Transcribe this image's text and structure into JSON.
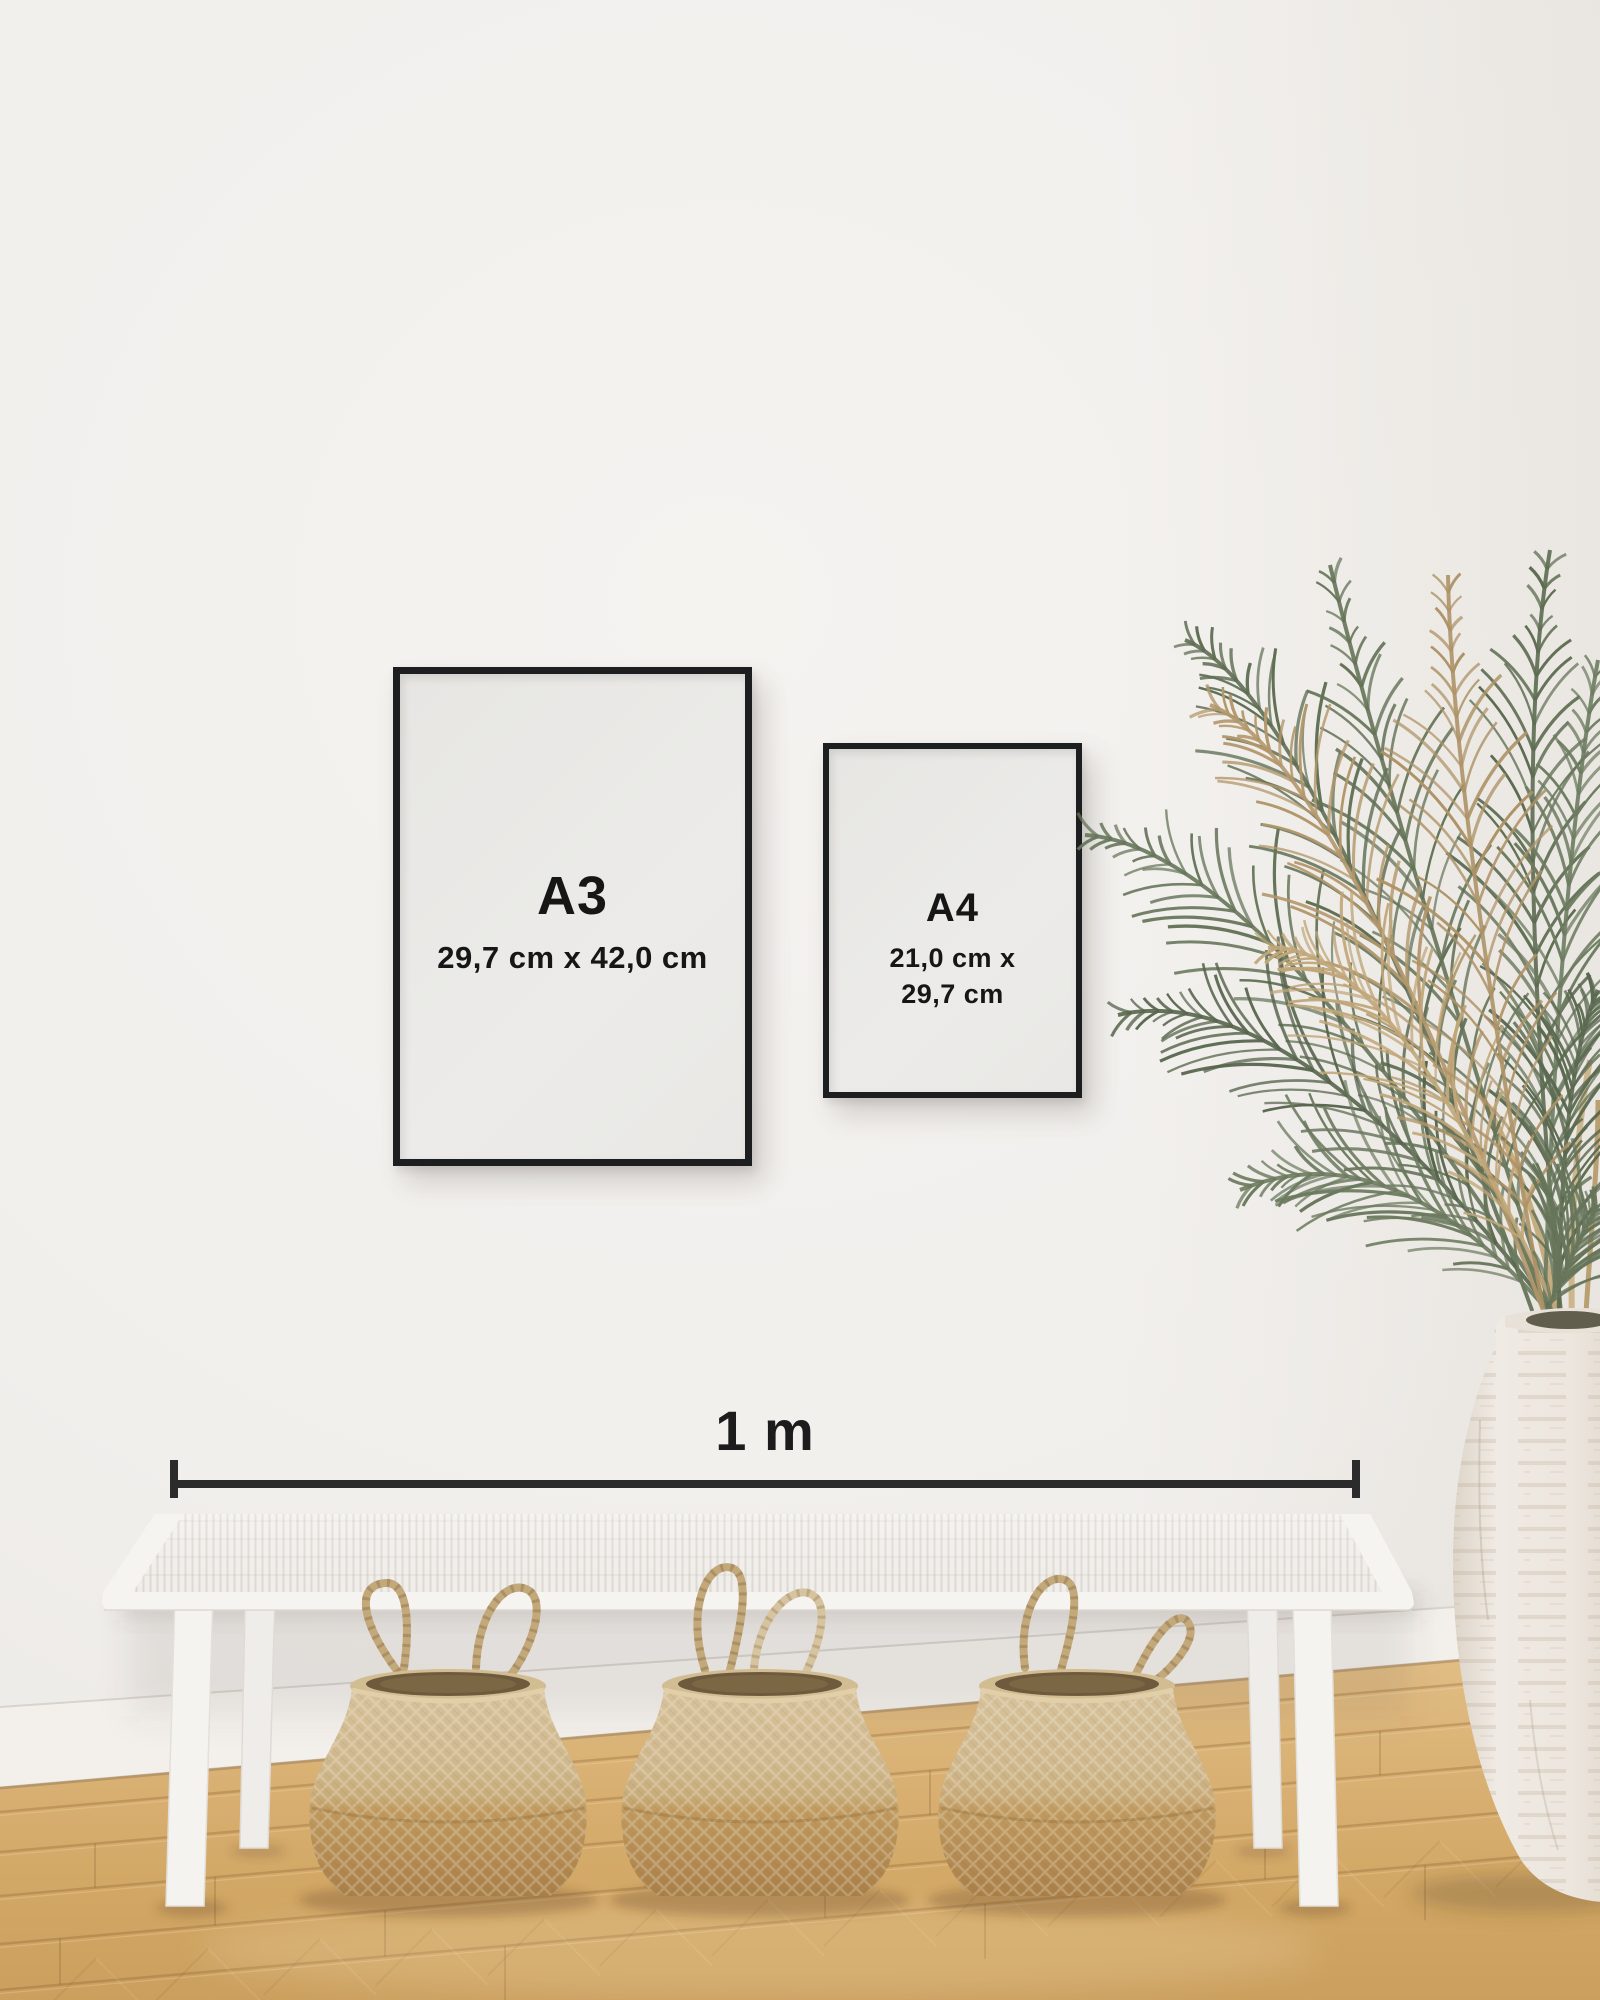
{
  "frames": [
    {
      "id": "a3",
      "label": "A3",
      "dimensions": "29,7 cm x 42,0 cm"
    },
    {
      "id": "a4",
      "label": "A4",
      "dimensions_line1": "21,0 cm x",
      "dimensions_line2": "29,7 cm"
    }
  ],
  "scale_bar": {
    "label": "1 m"
  },
  "palette": {
    "wall": "#f1efec",
    "frame_black": "#1d1e20",
    "paper": "#eae9e6",
    "text_dark": "#161616",
    "scale_bar": "#2b2b2b",
    "floor_light": "#e2bf86",
    "floor_dark": "#cb9f5e",
    "bench_white": "#f3f1ed",
    "basket_light": "#d9c6a1",
    "basket_dark": "#a87e47",
    "plant_green": "#647357",
    "plant_dried": "#b3976b",
    "vase_white": "#efeae3"
  }
}
